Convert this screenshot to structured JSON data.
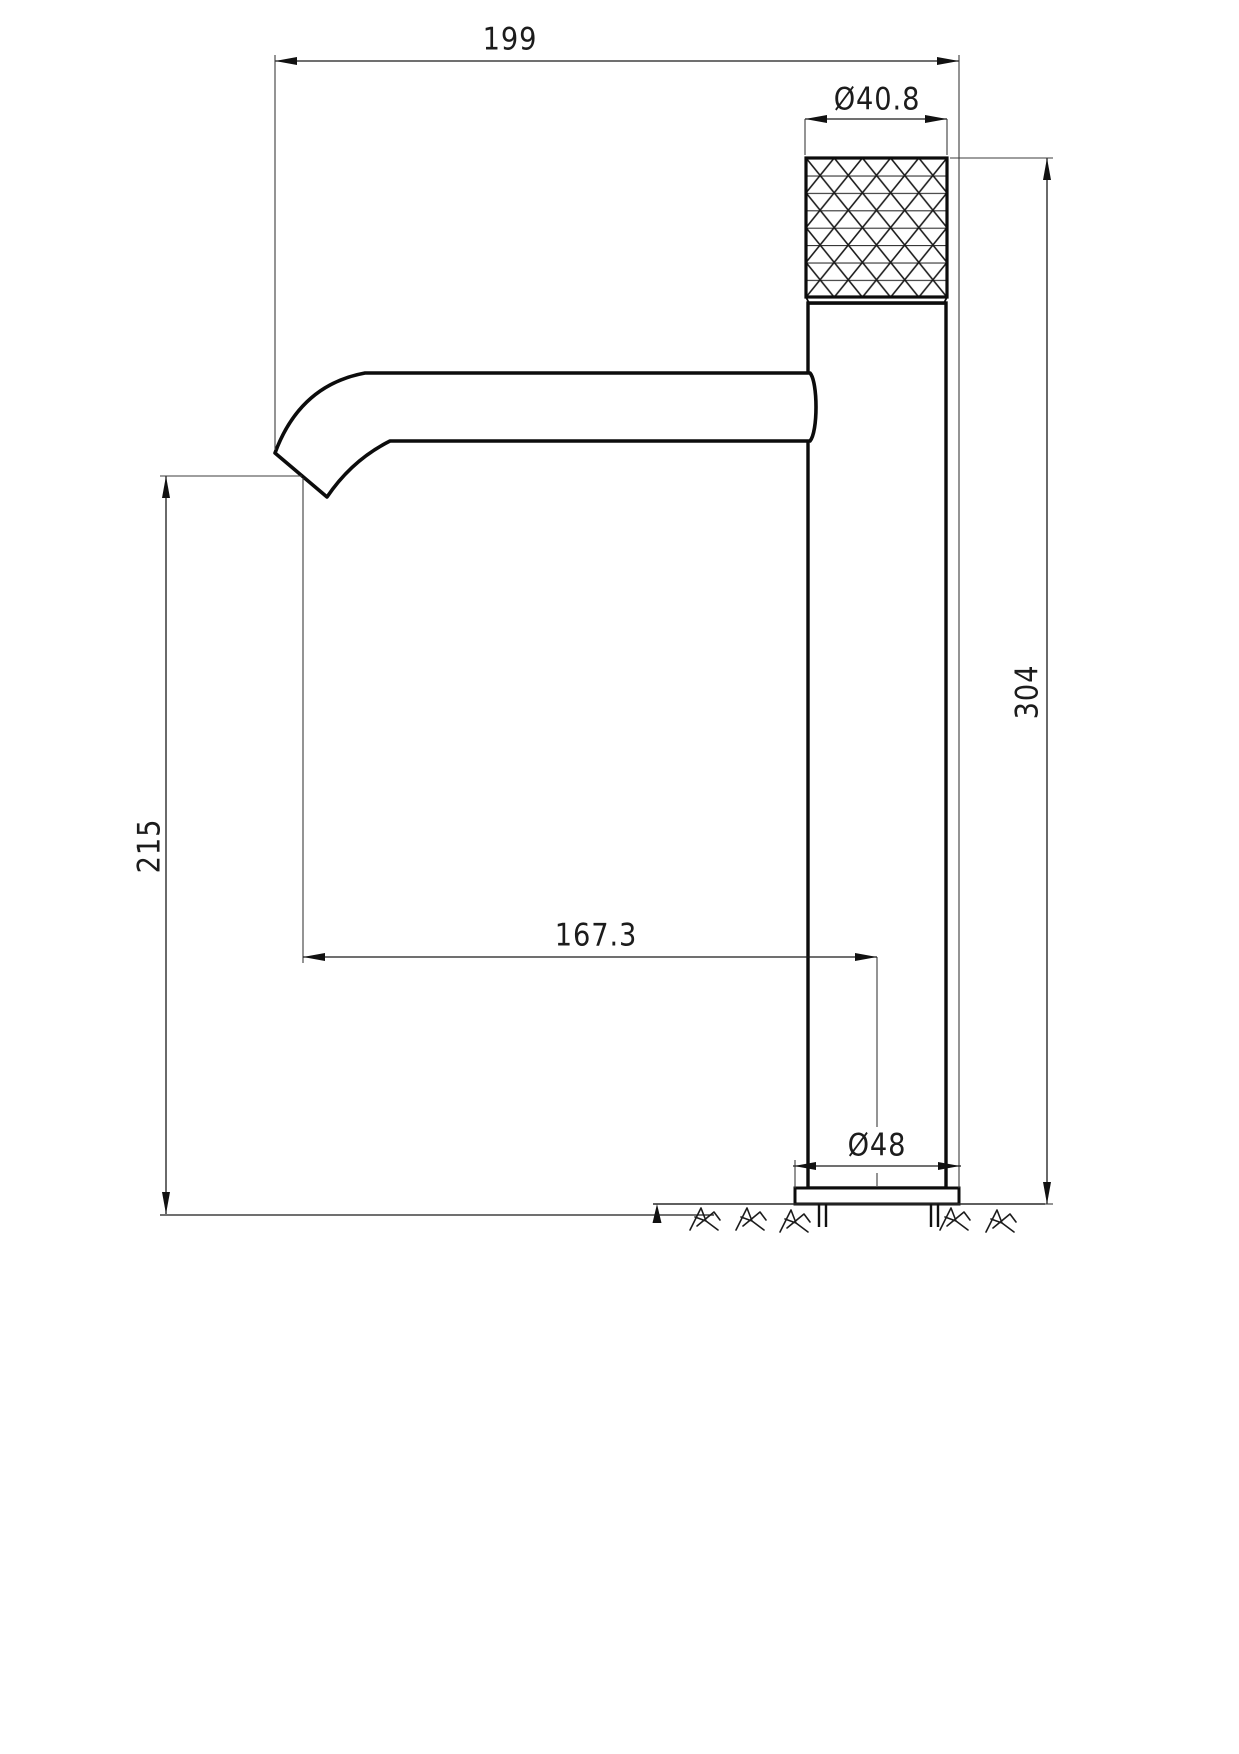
{
  "drawing": {
    "type": "faucet-dimension-drawing",
    "background_color": "#ffffff",
    "line_color": "#141414",
    "thin_line_color": "#3c3c3c",
    "dimensions": {
      "overall_reach": {
        "label": "199"
      },
      "handle_diameter": {
        "label": "Ø40.8"
      },
      "overall_height": {
        "label": "304"
      },
      "spout_height": {
        "label": "215"
      },
      "spout_projection": {
        "label": "167.3"
      },
      "base_diameter": {
        "label": "Ø48"
      }
    }
  }
}
